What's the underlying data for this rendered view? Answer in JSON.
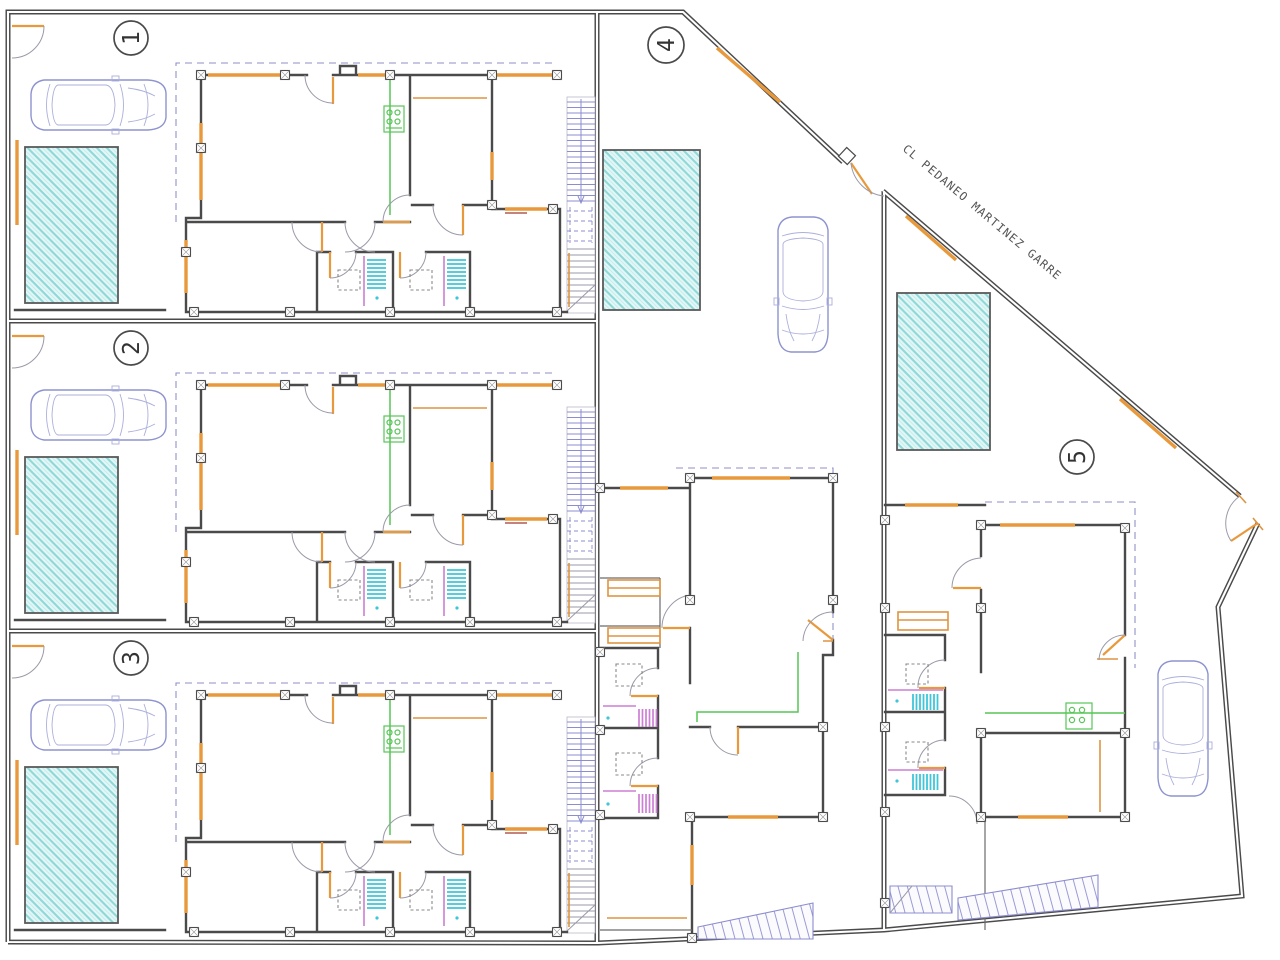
{
  "plan": {
    "title": "housing-site-floor-plan",
    "street_label": "CL PEDANEO MARTINEZ GARRE",
    "units": [
      {
        "label": "1"
      },
      {
        "label": "2"
      },
      {
        "label": "3"
      },
      {
        "label": "4"
      },
      {
        "label": "5"
      }
    ],
    "colors": {
      "wall": "#4a4a4a",
      "window_orange": "#e8993c",
      "pool_fill": "#e4f6f6",
      "pool_hatch": "#8fd8d8",
      "stair_blue": "#8c8cd0",
      "car_outline": "#8d93cf",
      "kitchen_green": "#57c657",
      "fixture_magenta": "#cc7fd4",
      "shower_cyan": "#3fc6d8",
      "setback_dash": "#8f8fc8"
    }
  }
}
